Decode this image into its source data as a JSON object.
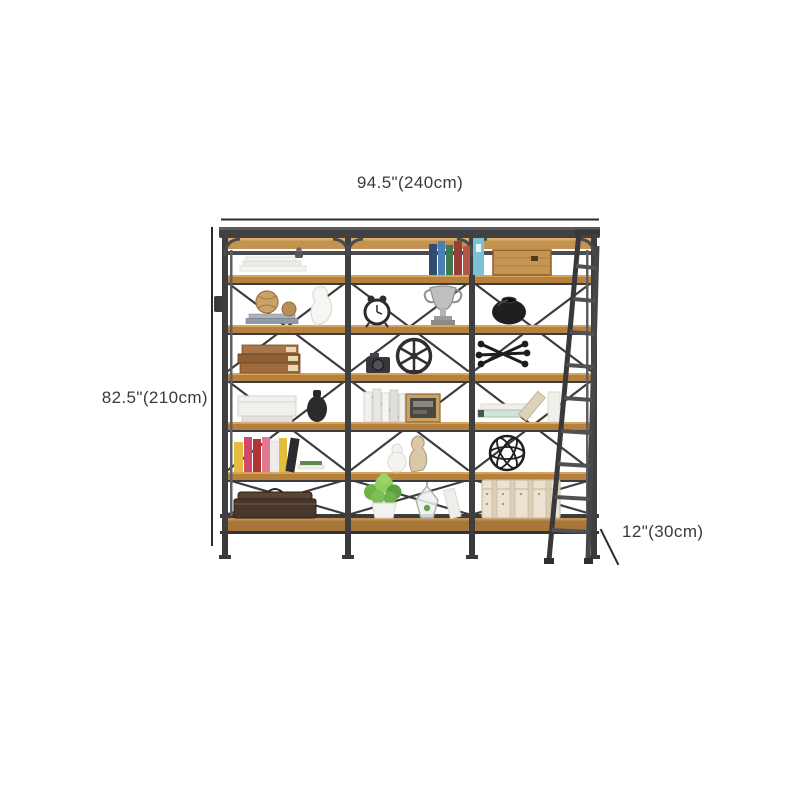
{
  "page": {
    "type": "product-dimension-diagram",
    "background": "#ffffff"
  },
  "annotations": {
    "width": {
      "label": "94.5\"(240cm)"
    },
    "height": {
      "label": "82.5\"(210cm)"
    },
    "depth": {
      "label": "12\"(30cm)"
    },
    "line_color": "#2b2b2b",
    "text_color": "#3a3a3a"
  },
  "product": {
    "name": "industrial three-bay etagere bookshelf with leaning ladder",
    "bays": 3,
    "shelves": 6,
    "has_ladder": true,
    "colors": {
      "metal_frame": "#3f3f42",
      "metal_light": "#55555a",
      "wood_shelf": "#b5813d",
      "wood_light": "#cf9f5a",
      "wood_dark": "#8a5c26"
    },
    "decor_items": [
      "stack of papers",
      "small figurine",
      "row of colorful books",
      "wooden crate",
      "rattan balls on books",
      "white curvy vase",
      "alarm clock",
      "silver trophy",
      "black pot",
      "antique book stack",
      "camera",
      "spoked wheel ornament",
      "black jack sculpture",
      "white storage box",
      "black vase",
      "white books",
      "picture frame",
      "stacked mint books",
      "leaning beige book",
      "white upright book",
      "colorful book row",
      "white sculpted vase",
      "beige gourd vase",
      "black wire sphere",
      "dark briefcase",
      "potted green plant",
      "glass terrarium",
      "leaning white book",
      "canvas trunk"
    ]
  }
}
